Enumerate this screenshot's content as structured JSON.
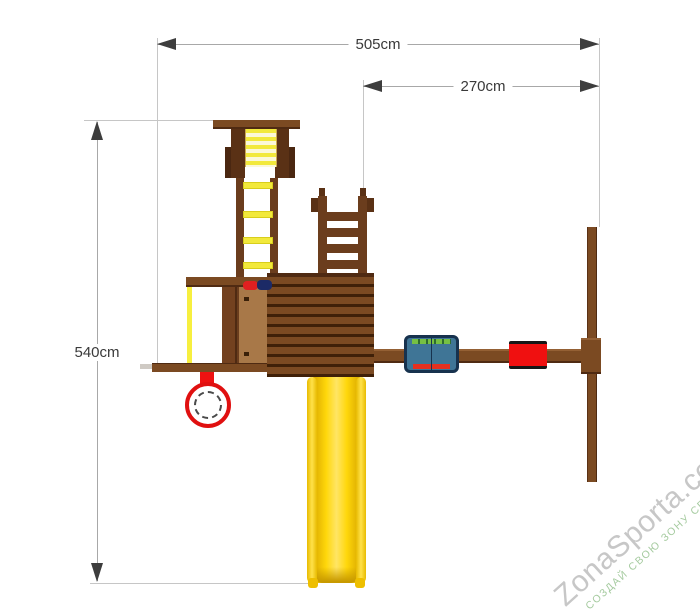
{
  "subject": {
    "type": "playground-set-top-view-dimension-diagram"
  },
  "dimensions": {
    "overall_width": {
      "label": "505cm",
      "value_cm": 505
    },
    "right_section_width": {
      "label": "270cm",
      "value_cm": 270
    },
    "overall_depth": {
      "label": "540cm",
      "value_cm": 540
    }
  },
  "watermark": {
    "brand": "ZonaSporta.com",
    "slogan": "СОЗДАЙ СВОЮ ЗОНУ СПОРТА"
  },
  "colors": {
    "wood": "#7b4a22",
    "wood_dark": "#5a3115",
    "roof_gap": "#3f2008",
    "rung_yellow": "#f2e93c",
    "slide_yellow": "#ffd70a",
    "accent_red": "#ee1111",
    "swing_blue": "#3f7596",
    "swing_green": "#76c043",
    "dim_line": "#a8a8a8",
    "dim_arrow": "#3d3d3d",
    "dim_text": "#3a3a3a",
    "watermark_gray": "#c7c7c7",
    "watermark_green": "#a6cba0"
  }
}
